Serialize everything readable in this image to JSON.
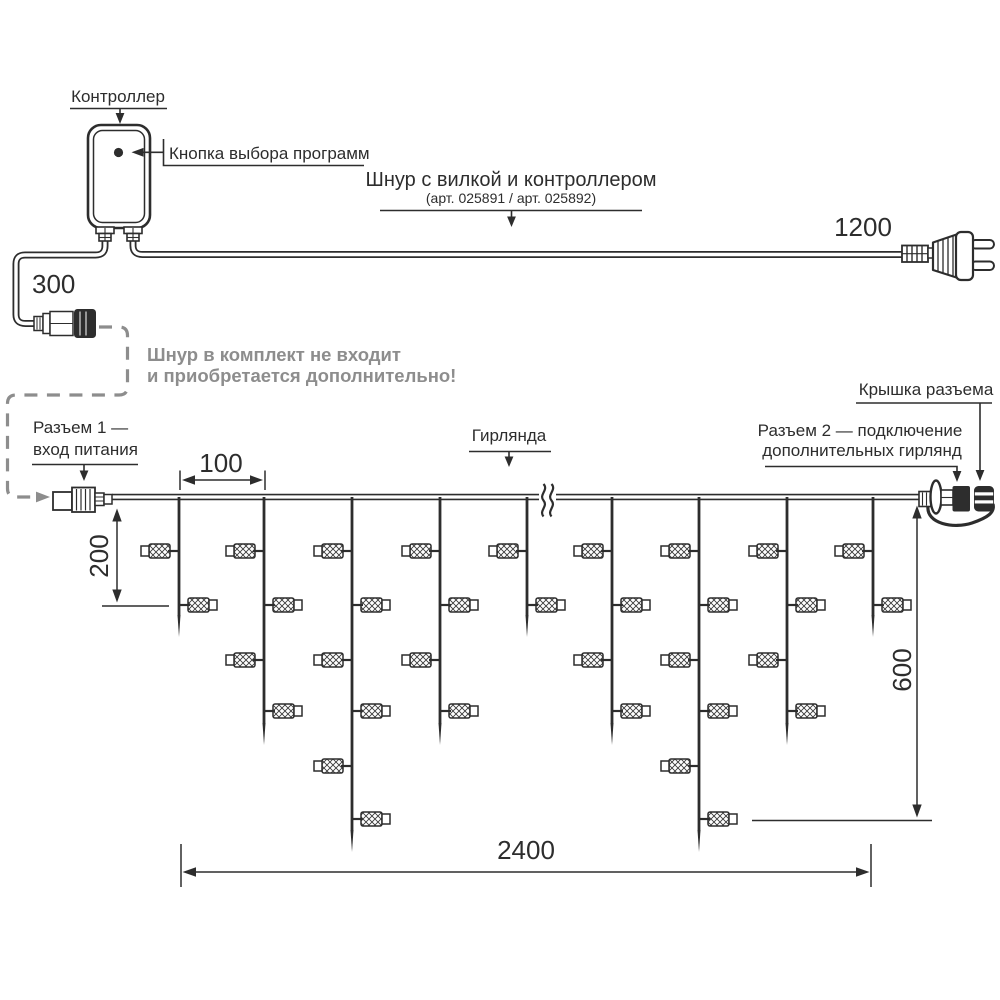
{
  "colors": {
    "line": "#2d2d2d",
    "gray": "#8d8d8d",
    "background": "#ffffff"
  },
  "labels": {
    "controller": "Контроллер",
    "program_button": "Кнопка выбора программ",
    "cord_title": "Шнур с вилкой и контроллером",
    "cord_articles": "(арт. 025891 / арт. 025892)",
    "note_line1": "Шнур в комплект не входит",
    "note_line2": "и приобретается дополнительно!",
    "connector1_line1": "Разъем 1 —",
    "connector1_line2": "вход питания",
    "garland": "Гирлянда",
    "connector2_line1": "Разъем 2 — подключение",
    "connector2_line2": "дополнительных гирлянд",
    "connector_cap": "Крышка разъема"
  },
  "dimensions": {
    "spacing": "100",
    "drop_length": "200",
    "input_cord": "300",
    "height": "600",
    "plug_cord": "1200",
    "total_length": "2400"
  },
  "garland": {
    "wire_y": 497,
    "lamp_rows_y": [
      551,
      605,
      660,
      711,
      766,
      819
    ],
    "tip_y": {
      "short": 637,
      "medium": 745,
      "long": 852
    },
    "drops": [
      {
        "x": 179,
        "type": "short",
        "lamps": 2
      },
      {
        "x": 264,
        "type": "medium",
        "lamps": 4
      },
      {
        "x": 352,
        "type": "long",
        "lamps": 6
      },
      {
        "x": 440,
        "type": "medium",
        "lamps": 4
      },
      {
        "x": 527,
        "type": "short",
        "lamps": 2
      },
      {
        "x": 612,
        "type": "medium",
        "lamps": 4
      },
      {
        "x": 699,
        "type": "long",
        "lamps": 6
      },
      {
        "x": 787,
        "type": "medium",
        "lamps": 4
      },
      {
        "x": 873,
        "type": "short",
        "lamps": 2
      }
    ]
  }
}
